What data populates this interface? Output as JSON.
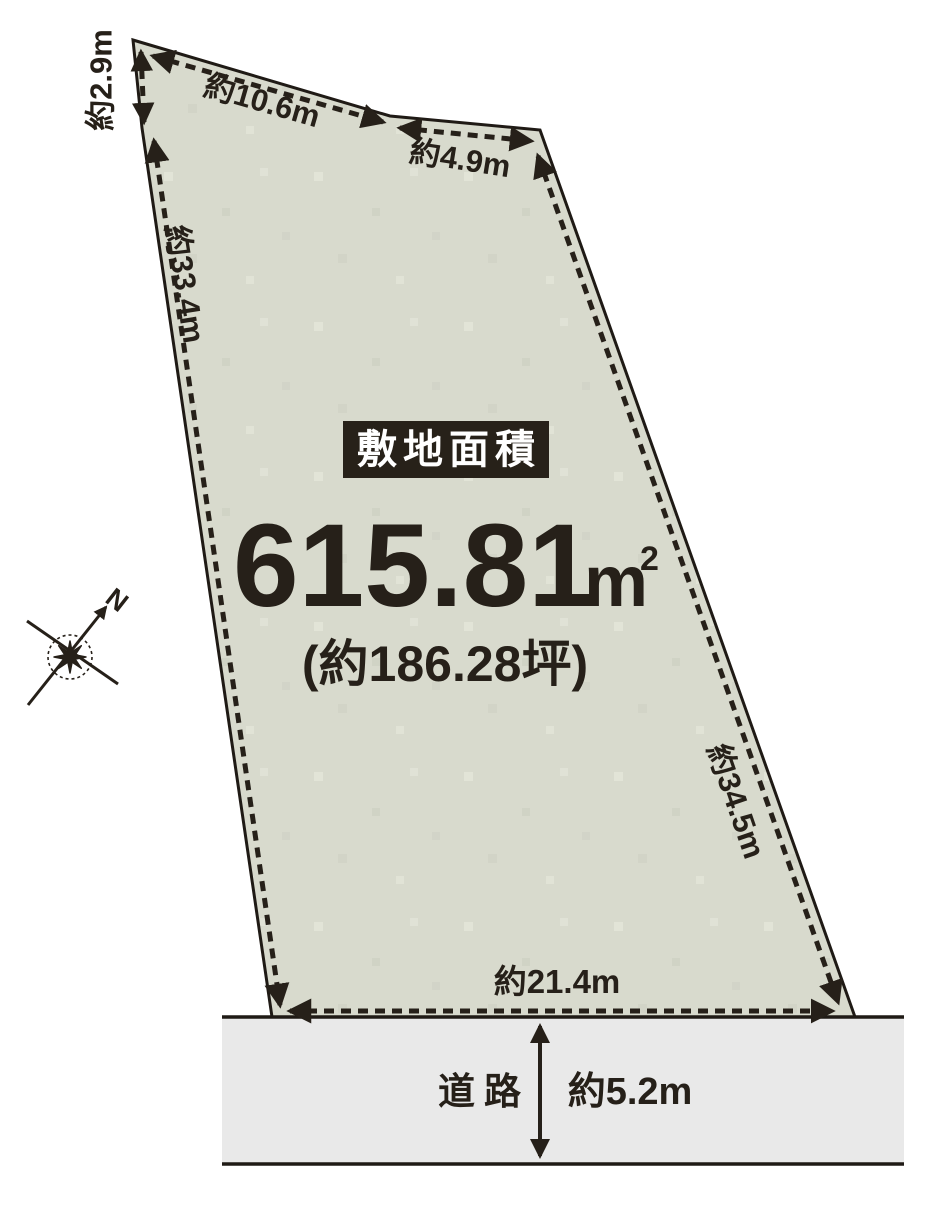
{
  "plan": {
    "badge_label": "敷地面積",
    "area": {
      "value": "615.81",
      "unit": "m",
      "unit_sup": "2",
      "tsubo": "(約186.28坪)"
    },
    "edges": {
      "top_left": "約2.9m",
      "top": "約10.6m",
      "top_right": "約4.9m",
      "left": "約33.4m",
      "right": "約34.5m",
      "bottom": "約21.4m"
    },
    "road": {
      "label": "道路",
      "width": "約5.2m"
    },
    "compass": {
      "north": "N"
    },
    "colors": {
      "land_fill": "#d8dacd",
      "road_fill": "#e9e9e9",
      "line": "#262019",
      "badge_bg": "#272119",
      "badge_text": "#ffffff",
      "background": "#ffffff"
    }
  }
}
